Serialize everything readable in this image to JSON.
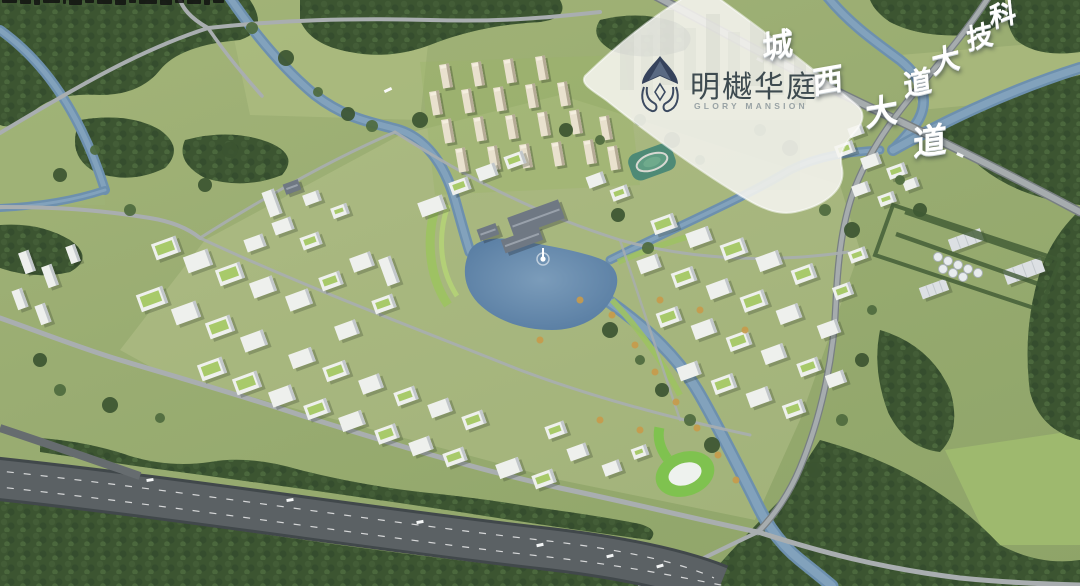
{
  "branding_card": {
    "title": "明樾华庭",
    "subtitle": "GLORY MANSION",
    "logo_icon": "mingyue-emblem"
  },
  "road_labels": [
    {
      "id": "chengxi-avenue",
      "text": "城西大道"
    },
    {
      "id": "keji-avenue",
      "text": "科技大道"
    }
  ],
  "watermark": {
    "fragment_count": 16
  },
  "scene_features": {
    "lake_fountain": true,
    "central_lake": true,
    "riverside_highway": true,
    "residential_towers": true,
    "office_campus": true
  },
  "palette": {
    "field_green": "#9db073",
    "meadow_light": "#b5c489",
    "tree_dark": "#3c5531",
    "tree_mid": "#4e6a3e",
    "water": "#6d90ae",
    "lake": "#5a7fa6",
    "road_grey": "#a6acae",
    "highway_dark": "#54595c",
    "building_white": "#eef0ed",
    "green_roof": "#a8ca6a",
    "tower_beige": "#e9e1ce",
    "card_bg": "rgba(246,245,240,0.88)",
    "logo_navy": "#36435c",
    "title_ink": "#3e4b50",
    "label_white": "#ffffff"
  }
}
